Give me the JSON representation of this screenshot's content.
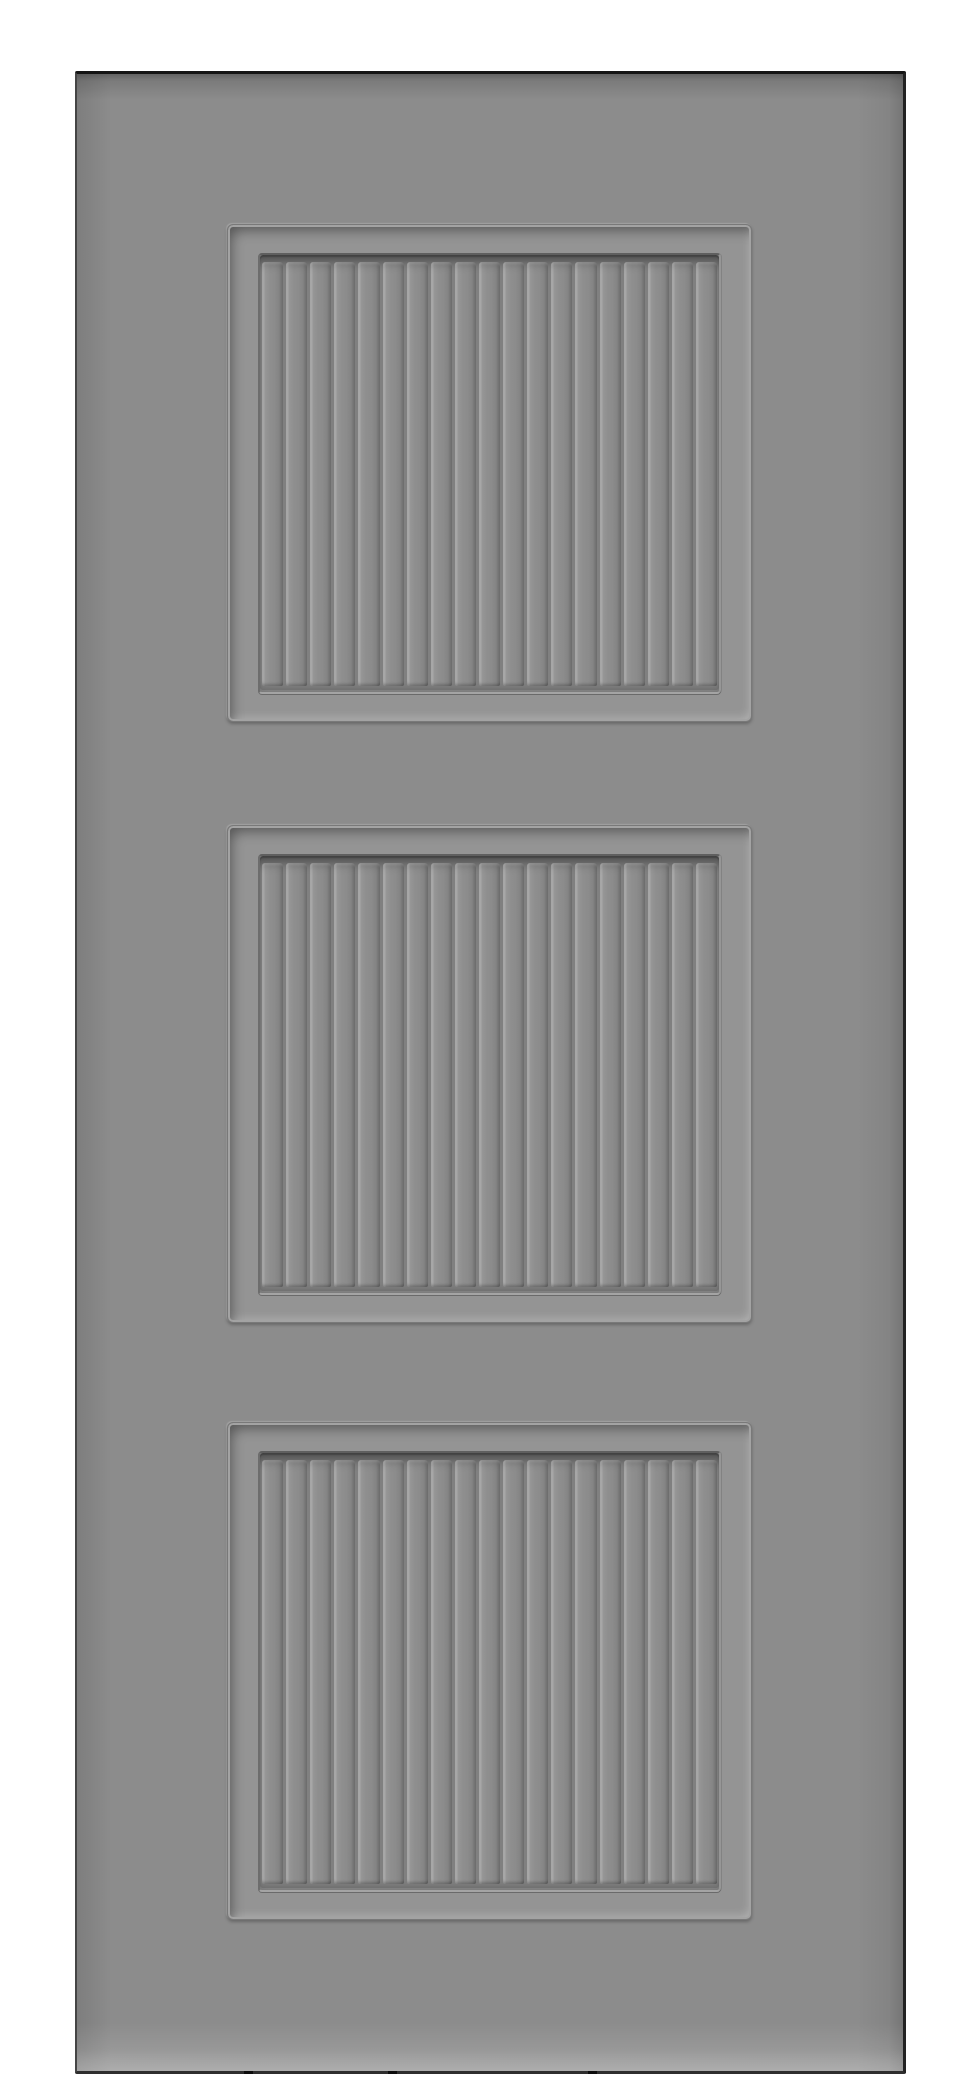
{
  "meta": {
    "type": "product-photo",
    "description": "Rendered product image of a gray interior door slab with three square recessed beadboard panels on a white background",
    "background_color": "#ffffff"
  },
  "door": {
    "label": "Gray three-panel beadboard door slab",
    "panel_count": 3,
    "slats_per_panel": 19,
    "colors": {
      "background": "#ffffff",
      "door_face": "#8c8c8c",
      "panel_margin": "#949494",
      "groove_channel": "#808080",
      "slat_face": "#8e8e8e",
      "slat_highlight": "#a7a7a7",
      "slat_shadow": "#6a6a6a",
      "top_edge": "#141414"
    },
    "panels": [
      {
        "name": "top-panel",
        "slat_count": 19
      },
      {
        "name": "middle-panel",
        "slat_count": 19
      },
      {
        "name": "bottom-panel",
        "slat_count": 19
      }
    ]
  }
}
